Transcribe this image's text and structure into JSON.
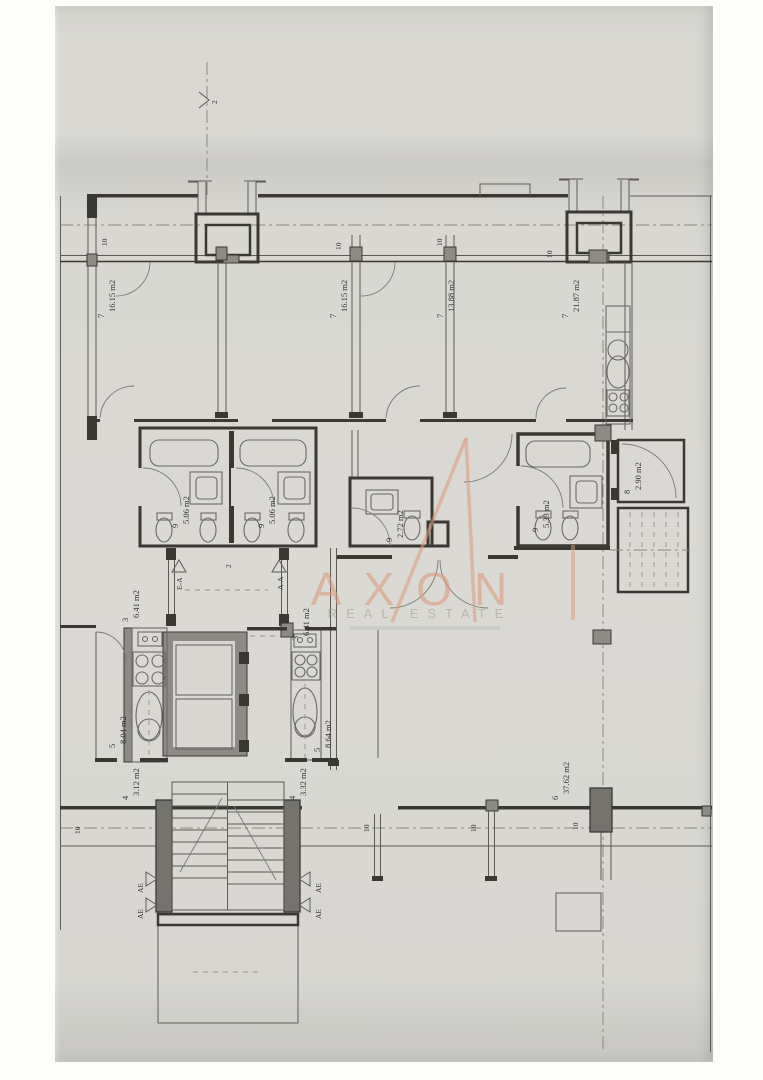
{
  "watermark": {
    "brand": "AXON",
    "subtitle": "REAL ESTATE",
    "accent": "#db9b7d"
  },
  "markers": {
    "axis_top": "2",
    "balcony": "10",
    "corridor_num": "2",
    "section_ea": "E-A",
    "section_aa": "A-A",
    "section_ae": "AE"
  },
  "rooms": {
    "bed1": {
      "num": "7",
      "area": "16.15 m2"
    },
    "bed2": {
      "num": "7",
      "area": "16.15 m2"
    },
    "bed3": {
      "num": "7",
      "area": "13.88 m2"
    },
    "bed4": {
      "num": "7",
      "area": "21.87 m2"
    },
    "bath1": {
      "num": "9",
      "area": "5.06 m2"
    },
    "bath2": {
      "num": "9",
      "area": "5.06 m2"
    },
    "wc": {
      "num": "9",
      "area": "2.72 m2"
    },
    "bath3": {
      "num": "9",
      "area": "5.33 m2"
    },
    "closet": {
      "num": "8",
      "area": "2.90 m2"
    },
    "hall1": {
      "num": "3",
      "area": "6.41 m2"
    },
    "hall2": {
      "num": "3",
      "area": "6.41 m2"
    },
    "kitchen1": {
      "num": "5",
      "area": "8.04 m2"
    },
    "kitchen2": {
      "num": "5",
      "area": "8.64 m2"
    },
    "balc1": {
      "num": "4",
      "area": "3.12 m2"
    },
    "balc2": {
      "num": "4",
      "area": "3.32 m2"
    },
    "living": {
      "num": "6",
      "area": "37.62 m2"
    }
  },
  "colors": {
    "paper": "#d8d7d2",
    "ink": "#3a3833",
    "accent": "#db9b7d"
  }
}
